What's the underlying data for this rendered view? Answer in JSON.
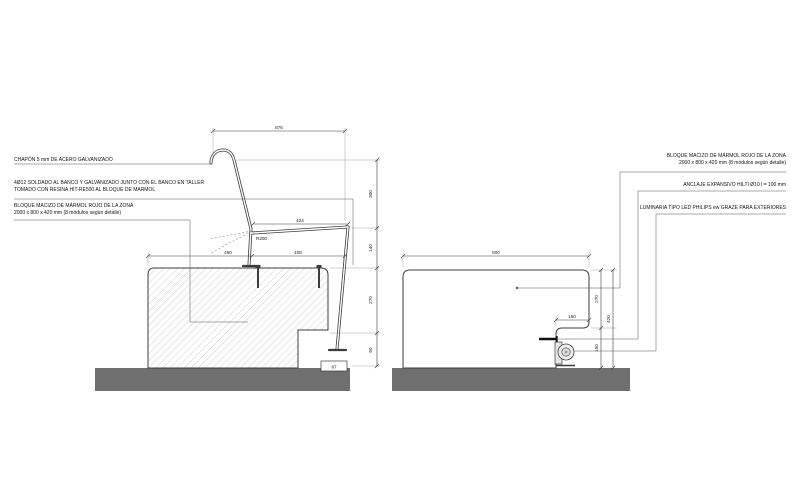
{
  "drawing_title": "Detalle constructivo banco de mármol",
  "callouts": {
    "left": [
      {
        "line1": "CHAPÓN 5 mm DE ACERO GALVANIZADO"
      },
      {
        "line1": "4Ø12 SOLDADO AL BANCO Y GALVANIZADO JUNTO CON EL BANCO EN TALLER",
        "line2": "TOMADO CON RESINA HIT-RE500 AL BLOQUE DE MARMOL"
      },
      {
        "line1": "BLOQUE MACIZO DE MÁRMOL ROJO DE LA ZONA",
        "line2": "2000 x 800 x 420 mm (8 módulos según detalle)"
      }
    ],
    "right": [
      {
        "line1": "BLOQUE MACIZO DE MÁRMOL ROJO DE LA ZONA",
        "line2": "2000 x 800 x 420 mm (8 módulos según detalle)"
      },
      {
        "line1": "ANCLAJE EXPANSIVO HILTI Ø10 l = 100 mm"
      },
      {
        "line1": "LUMINARIA TIPO LED PHILIPS ew GRAZE PARA EXTERIORES"
      }
    ]
  },
  "left_view": {
    "name": "sección banco con respaldo de acero",
    "dims": {
      "top_width": "876",
      "seat_width": "424",
      "front_width": "450",
      "rear_width": "408",
      "backrest_height": "300",
      "seat_gap": "140",
      "block_upper": "270",
      "block_base": "60",
      "foot_detail": "87",
      "bend_note": "R200"
    }
  },
  "right_view": {
    "name": "sección bloque de mármol con luminaria",
    "dims": {
      "width": "800",
      "upper_height": "270",
      "total_height": "420",
      "notch_width": "150",
      "notch_height": "150"
    }
  },
  "colors": {
    "line": "#3c3c3c",
    "light_line": "#8a8a8a",
    "hatch": "#c6c6c6",
    "ground": "#6f6f6f",
    "background": "#ffffff"
  }
}
